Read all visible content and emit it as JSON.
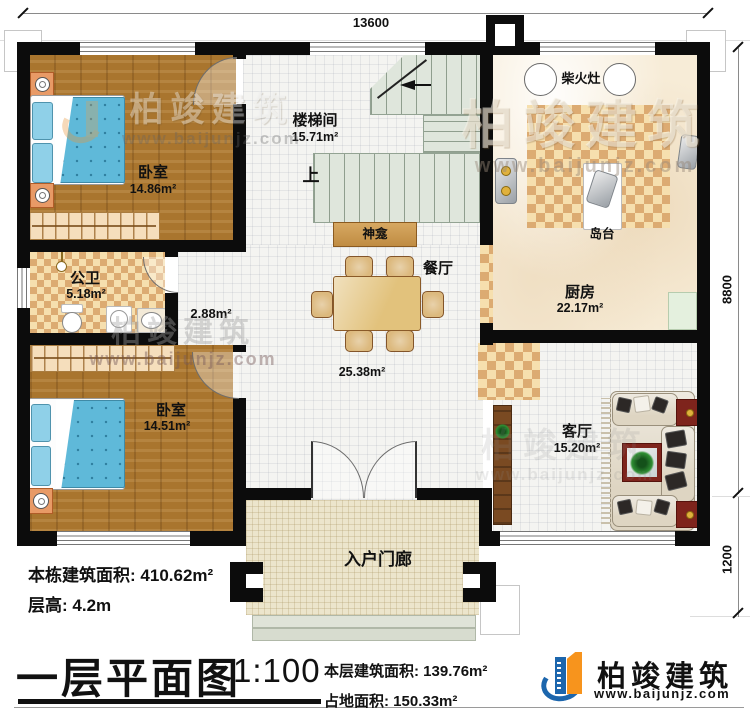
{
  "dimensions": {
    "top": "13600",
    "side": "8800",
    "porch": "1200"
  },
  "rooms": {
    "bedroom1": {
      "name": "卧室",
      "area": "14.86m²"
    },
    "stairwell": {
      "name": "楼梯间",
      "area": "15.71m²",
      "up_label": "上"
    },
    "shrine": {
      "name": "神龛"
    },
    "kitchen": {
      "name": "厨房",
      "area": "22.17m²",
      "stove_label": "柴火灶",
      "island_label": "岛台"
    },
    "dining": {
      "name": "餐厅",
      "area": "25.38m²"
    },
    "corridor": {
      "area": "2.88m²"
    },
    "bathroom": {
      "name": "公卫",
      "area": "5.18m²"
    },
    "bedroom2": {
      "name": "卧室",
      "area": "14.51m²"
    },
    "living": {
      "name": "客厅",
      "area": "15.20m²"
    },
    "porch": {
      "name": "入户门廊"
    }
  },
  "stats": {
    "total_area_label": "本栋建筑面积:",
    "total_area_value": "410.62m²",
    "floor_height_label": "层高:",
    "floor_height_value": "4.2m"
  },
  "title_block": {
    "title": "一层平面图",
    "scale": "1:100",
    "floor_area_label": "本层建筑面积:",
    "floor_area_value": "139.76m²",
    "footprint_label": "占地面积:",
    "footprint_value": "150.33m²"
  },
  "brand": {
    "name": "柏竣建筑",
    "site": "www.baijunjz.com"
  },
  "colors": {
    "wall": "#0c0c0c",
    "wood": "#a9752e",
    "brand_blue": "#1c66ad",
    "brand_orange": "#f7941d",
    "accent_red": "#7e241c"
  }
}
